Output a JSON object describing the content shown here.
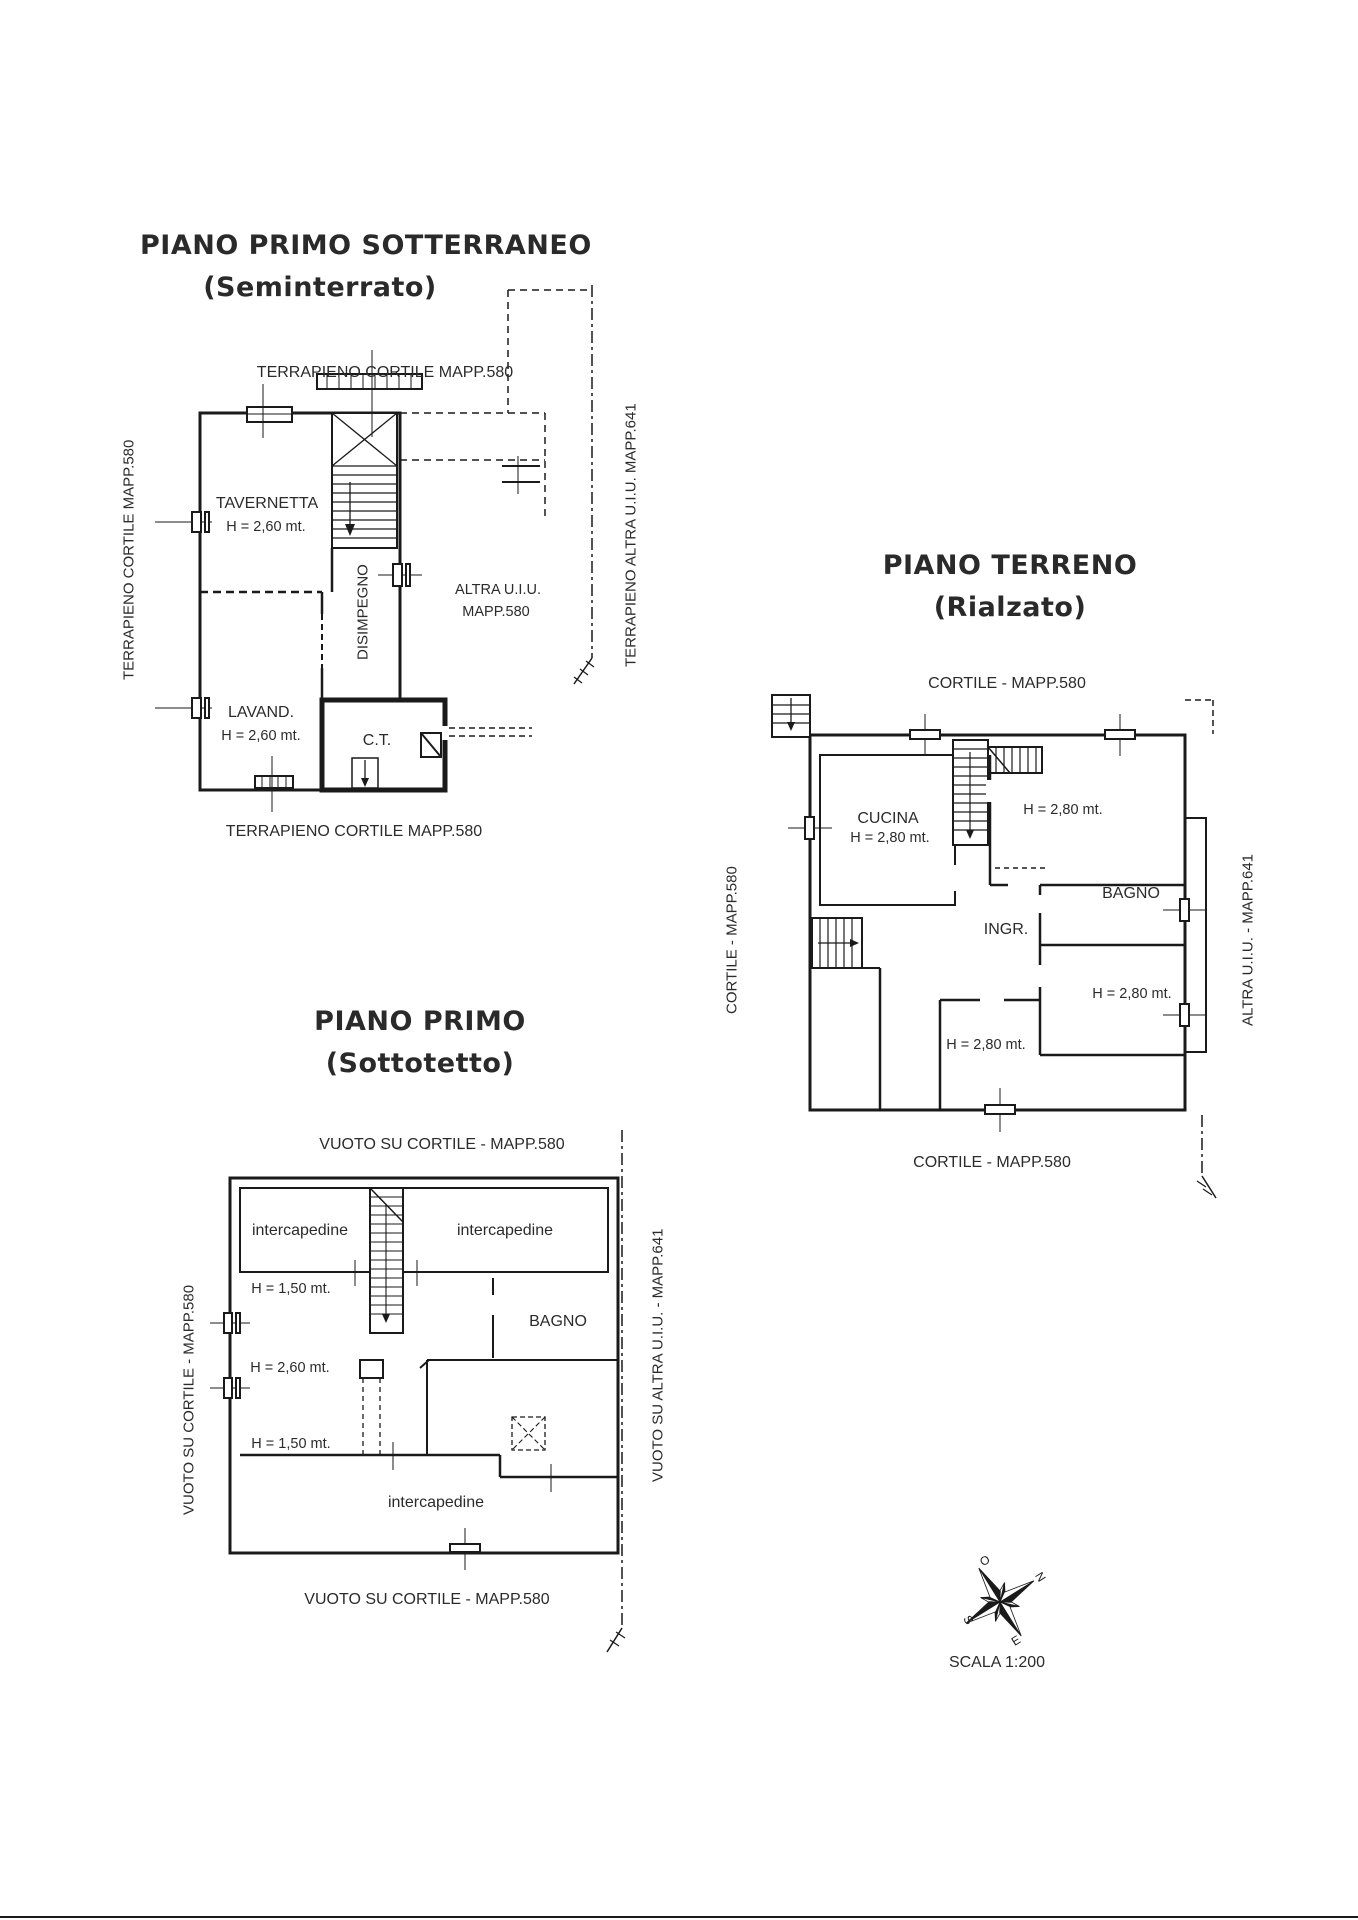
{
  "page": {
    "scale_label": "SCALA 1:200",
    "compass": {
      "n": "N",
      "e": "E",
      "s": "S",
      "o": "O"
    }
  },
  "plans": {
    "seminterrato": {
      "title": "PIANO PRIMO SOTTERRANEO",
      "subtitle": "(Seminterrato)",
      "label_top": "TERRAPIENO CORTILE MAPP.580",
      "label_bottom": "TERRAPIENO CORTILE MAPP.580",
      "label_left": "TERRAPIENO CORTILE MAPP.580",
      "label_right": "TERRAPIENO ALTRA U.I.U. MAPP.641",
      "rooms": {
        "tavernetta": {
          "name": "TAVERNETTA",
          "height": "H = 2,60 mt."
        },
        "disimpegno": {
          "name": "DISIMPEGNO"
        },
        "lavanderia": {
          "name": "LAVAND.",
          "height": "H = 2,60 mt."
        },
        "centrale_termica": {
          "name": "C.T."
        },
        "altra_uiu": {
          "name": "ALTRA U.I.U.",
          "mappale": "MAPP.580"
        }
      }
    },
    "terreno": {
      "title": "PIANO TERRENO",
      "subtitle": "(Rialzato)",
      "label_top": "CORTILE - MAPP.580",
      "label_bottom": "CORTILE - MAPP.580",
      "label_left": "CORTILE - MAPP.580",
      "label_right": "ALTRA U.I.U. - MAPP.641",
      "rooms": {
        "cucina": {
          "name": "CUCINA",
          "height": "H = 2,80 mt."
        },
        "camera_nord": {
          "height": "H = 2,80 mt."
        },
        "bagno": {
          "name": "BAGNO"
        },
        "ingresso": {
          "name": "INGR."
        },
        "camera_est": {
          "height": "H = 2,80 mt."
        },
        "camera_sud": {
          "height": "H = 2,80 mt."
        }
      }
    },
    "sottotetto": {
      "title": "PIANO PRIMO",
      "subtitle": "(Sottotetto)",
      "label_top": "VUOTO SU CORTILE - MAPP.580",
      "label_bottom": "VUOTO SU CORTILE - MAPP.580",
      "label_left": "VUOTO SU CORTILE - MAPP.580",
      "label_right": "VUOTO SU ALTRA U.I.U. - MAPP.641",
      "rooms": {
        "intercapedine_nord_ovest": {
          "name": "intercapedine"
        },
        "intercapedine_nord_est": {
          "name": "intercapedine"
        },
        "fascia_h150_nord": {
          "height": "H = 1,50 mt."
        },
        "locale_h260": {
          "height": "H = 2,60 mt."
        },
        "bagno": {
          "name": "BAGNO"
        },
        "fascia_h150_sud": {
          "height": "H = 1,50 mt."
        },
        "intercapedine_sud": {
          "name": "intercapedine"
        }
      }
    }
  }
}
